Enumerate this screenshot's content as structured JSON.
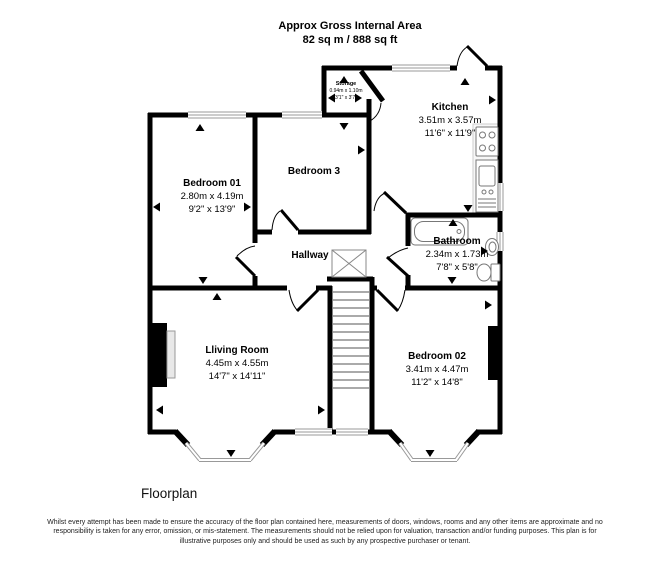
{
  "header": {
    "line1": "Approx Gross Internal Area",
    "line2": "82 sq m / 888 sq ft"
  },
  "rooms": {
    "storage": {
      "name": "Storage",
      "metric": "0.94m x 1.10m",
      "imperial": "3'1\" x 3'7\""
    },
    "kitchen": {
      "name": "Kitchen",
      "metric": "3.51m x 3.57m",
      "imperial": "11'6\" x 11'9\""
    },
    "bedroom01": {
      "name": "Bedroom 01",
      "metric": "2.80m x 4.19m",
      "imperial": "9'2\" x 13'9\""
    },
    "bedroom3": {
      "name": "Bedroom 3"
    },
    "hallway": {
      "name": "Hallway"
    },
    "bathroom": {
      "name": "Bathroom",
      "metric": "2.34m x 1.73m",
      "imperial": "7'8\" x 5'8\""
    },
    "living_room": {
      "name": "Lliving Room",
      "metric": "4.45m x 4.55m",
      "imperial": "14'7\" x 14'11\""
    },
    "bedroom02": {
      "name": "Bedroom 02",
      "metric": "3.41m x 4.47m",
      "imperial": "11'2\" x 14'8\""
    }
  },
  "fixtures": [
    "staircase",
    "landing-skylight",
    "bathtub",
    "toilet",
    "wash-basin",
    "kitchen-sink",
    "stove",
    "fireplace",
    "chimney-breast",
    "bay-window",
    "direction-markers"
  ],
  "colors": {
    "wall": "#000000",
    "window": "#999999",
    "fixture": "#777777",
    "background": "#ffffff"
  },
  "footer": {
    "caption": "Floorplan",
    "disclaimer": "Whilst every attempt has been made to ensure the accuracy of the floor plan contained here, measurements of doors, windows, rooms and any other items are approximate and no responsibility is taken for any error, omission, or mis-statement. The measurements should not be relied upon for valuation, transaction and/or funding purposes. This plan is for illustrative purposes only and should be used as such by any prospective purchaser or tenant."
  }
}
